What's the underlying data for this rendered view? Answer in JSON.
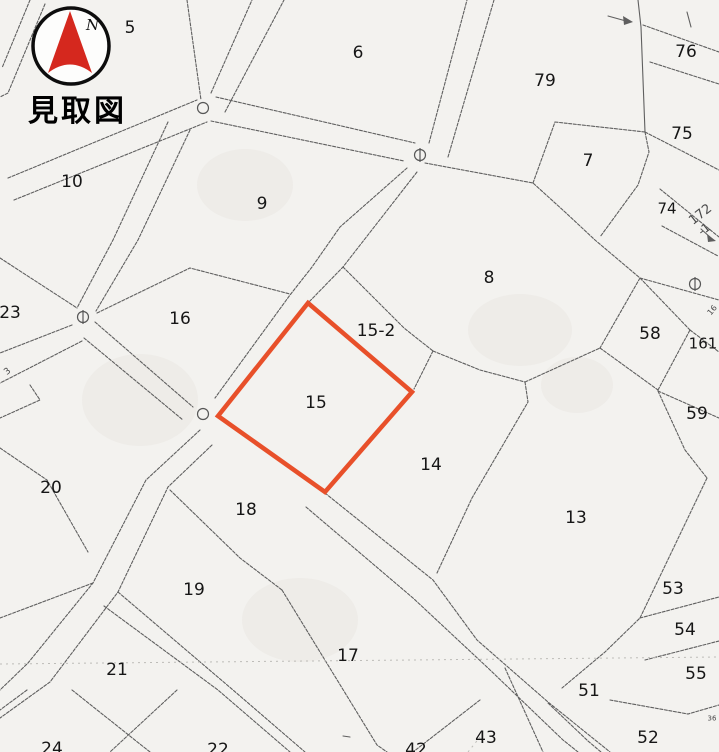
{
  "title": "見取図",
  "compass": {
    "north_label": "N"
  },
  "highlight": {
    "parcel": "15",
    "color": "#e8502a"
  },
  "map": {
    "parcels": [
      {
        "label": "5",
        "x": 130,
        "y": 27
      },
      {
        "label": "6",
        "x": 358,
        "y": 52
      },
      {
        "label": "79",
        "x": 545,
        "y": 80
      },
      {
        "label": "76",
        "x": 686,
        "y": 51
      },
      {
        "label": "75",
        "x": 682,
        "y": 133
      },
      {
        "label": "7",
        "x": 588,
        "y": 160
      },
      {
        "label": "74",
        "x": 667,
        "y": 208,
        "size": 15
      },
      {
        "label": "10",
        "x": 72,
        "y": 181
      },
      {
        "label": "9",
        "x": 262,
        "y": 203
      },
      {
        "label": "8",
        "x": 489,
        "y": 277
      },
      {
        "label": "23",
        "x": 10,
        "y": 312
      },
      {
        "label": "16",
        "x": 180,
        "y": 318
      },
      {
        "label": "15-2",
        "x": 376,
        "y": 330
      },
      {
        "label": "58",
        "x": 650,
        "y": 333
      },
      {
        "label": "161",
        "x": 703,
        "y": 343,
        "size": 15
      },
      {
        "label": "15",
        "x": 316,
        "y": 402
      },
      {
        "label": "59",
        "x": 697,
        "y": 413
      },
      {
        "label": "14",
        "x": 431,
        "y": 464
      },
      {
        "label": "20",
        "x": 51,
        "y": 487
      },
      {
        "label": "18",
        "x": 246,
        "y": 509
      },
      {
        "label": "13",
        "x": 576,
        "y": 517
      },
      {
        "label": "19",
        "x": 194,
        "y": 589
      },
      {
        "label": "53",
        "x": 673,
        "y": 588
      },
      {
        "label": "54",
        "x": 685,
        "y": 629
      },
      {
        "label": "17",
        "x": 348,
        "y": 655
      },
      {
        "label": "21",
        "x": 117,
        "y": 669
      },
      {
        "label": "55",
        "x": 696,
        "y": 673
      },
      {
        "label": "51",
        "x": 589,
        "y": 690
      },
      {
        "label": "52",
        "x": 648,
        "y": 737
      },
      {
        "label": "43",
        "x": 486,
        "y": 737
      },
      {
        "label": "42",
        "x": 416,
        "y": 749
      },
      {
        "label": "24",
        "x": 52,
        "y": 748
      },
      {
        "label": "22",
        "x": 218,
        "y": 749
      }
    ],
    "small_labels": [
      {
        "label": "172",
        "x": 700,
        "y": 214,
        "size": 13,
        "rotate": -38
      },
      {
        "label": "-1",
        "x": 704,
        "y": 229,
        "size": 12,
        "rotate": -38
      },
      {
        "label": "3",
        "x": 7,
        "y": 371,
        "size": 9,
        "rotate": -40
      },
      {
        "label": "16",
        "x": 712,
        "y": 310,
        "size": 8,
        "rotate": -50
      },
      {
        "label": "36",
        "x": 712,
        "y": 718,
        "size": 7,
        "rotate": 0
      }
    ]
  }
}
